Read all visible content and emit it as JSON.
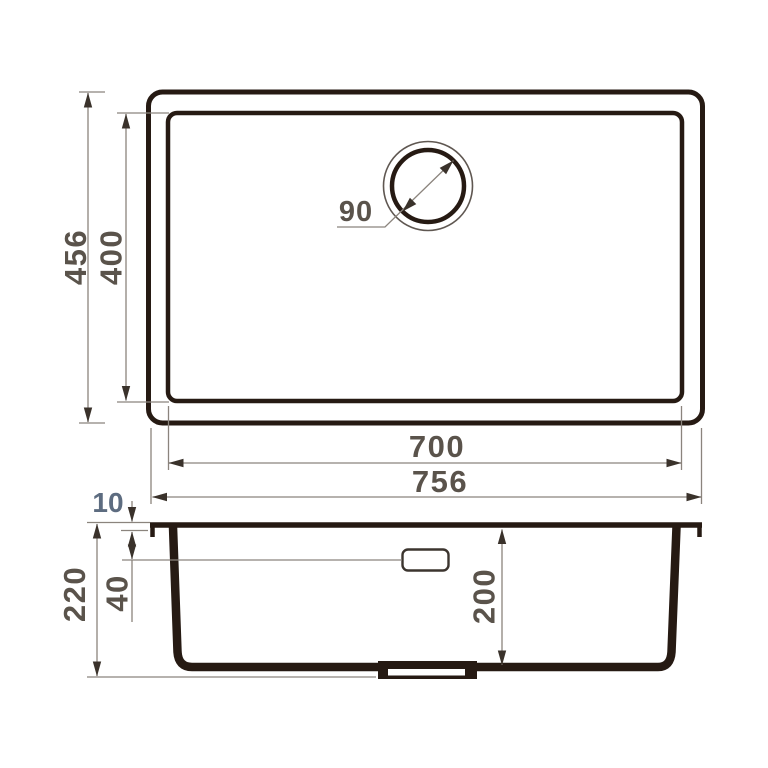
{
  "drawing": {
    "type": "technical-dimension-drawing",
    "subject": "undermount rectangular kitchen sink",
    "unit": "mm",
    "top_view": {
      "overall_depth": "456",
      "bowl_depth": "400",
      "drain_diameter": "90",
      "bowl_width": "700",
      "overall_width": "756"
    },
    "side_view": {
      "rim_thickness": "10",
      "overall_height": "220",
      "overflow_drop": "40",
      "bowl_inner_depth": "200"
    }
  },
  "colors": {
    "background": "#ffffff",
    "outline": "#261a13",
    "dim_line": "#8b847d",
    "arrow": "#3a322b",
    "dim_text": "#5a534b",
    "annotation_text": "#5d6c80"
  }
}
